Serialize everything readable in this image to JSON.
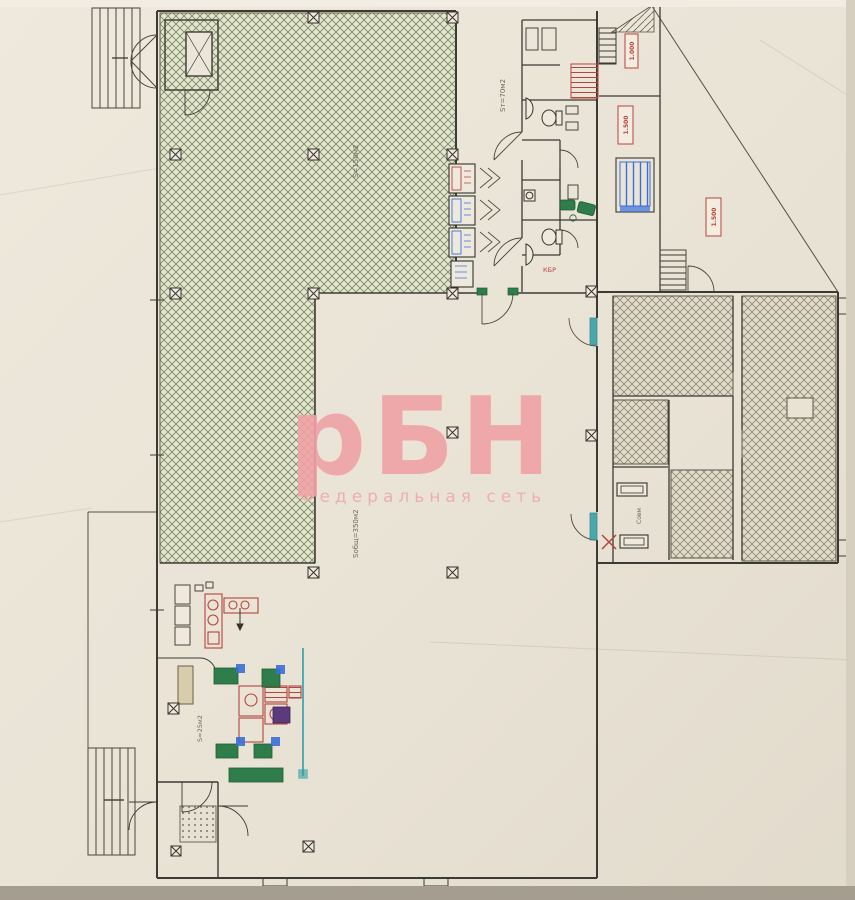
{
  "watermark": {
    "title": "рБН",
    "subtitle": "Федеральная сеть",
    "color": "#f0a2a6"
  },
  "annotations": {
    "hall_area": "S=150м2",
    "trade_area": "Sт=70м2",
    "storage_area": "Sобщ=350м2",
    "kitchen_area": "S=25м2",
    "wc_label": "Совм",
    "kbr_label": "КБР"
  },
  "elevations": [
    "1.000",
    "1.500",
    "1.500"
  ],
  "palette": {
    "paper": "#eae4d8",
    "walls": "#3b3a33",
    "hatch_green": "#7d8b60",
    "hatch_gray": "#968b79",
    "equipment_red": "#b5443c",
    "equipment_green": "#2e7d4a",
    "equipment_blue": "#3a6fd8",
    "equipment_teal": "#2f9ea6",
    "equipment_purple": "#5b3a7e",
    "marker_red": "#b5443c"
  }
}
